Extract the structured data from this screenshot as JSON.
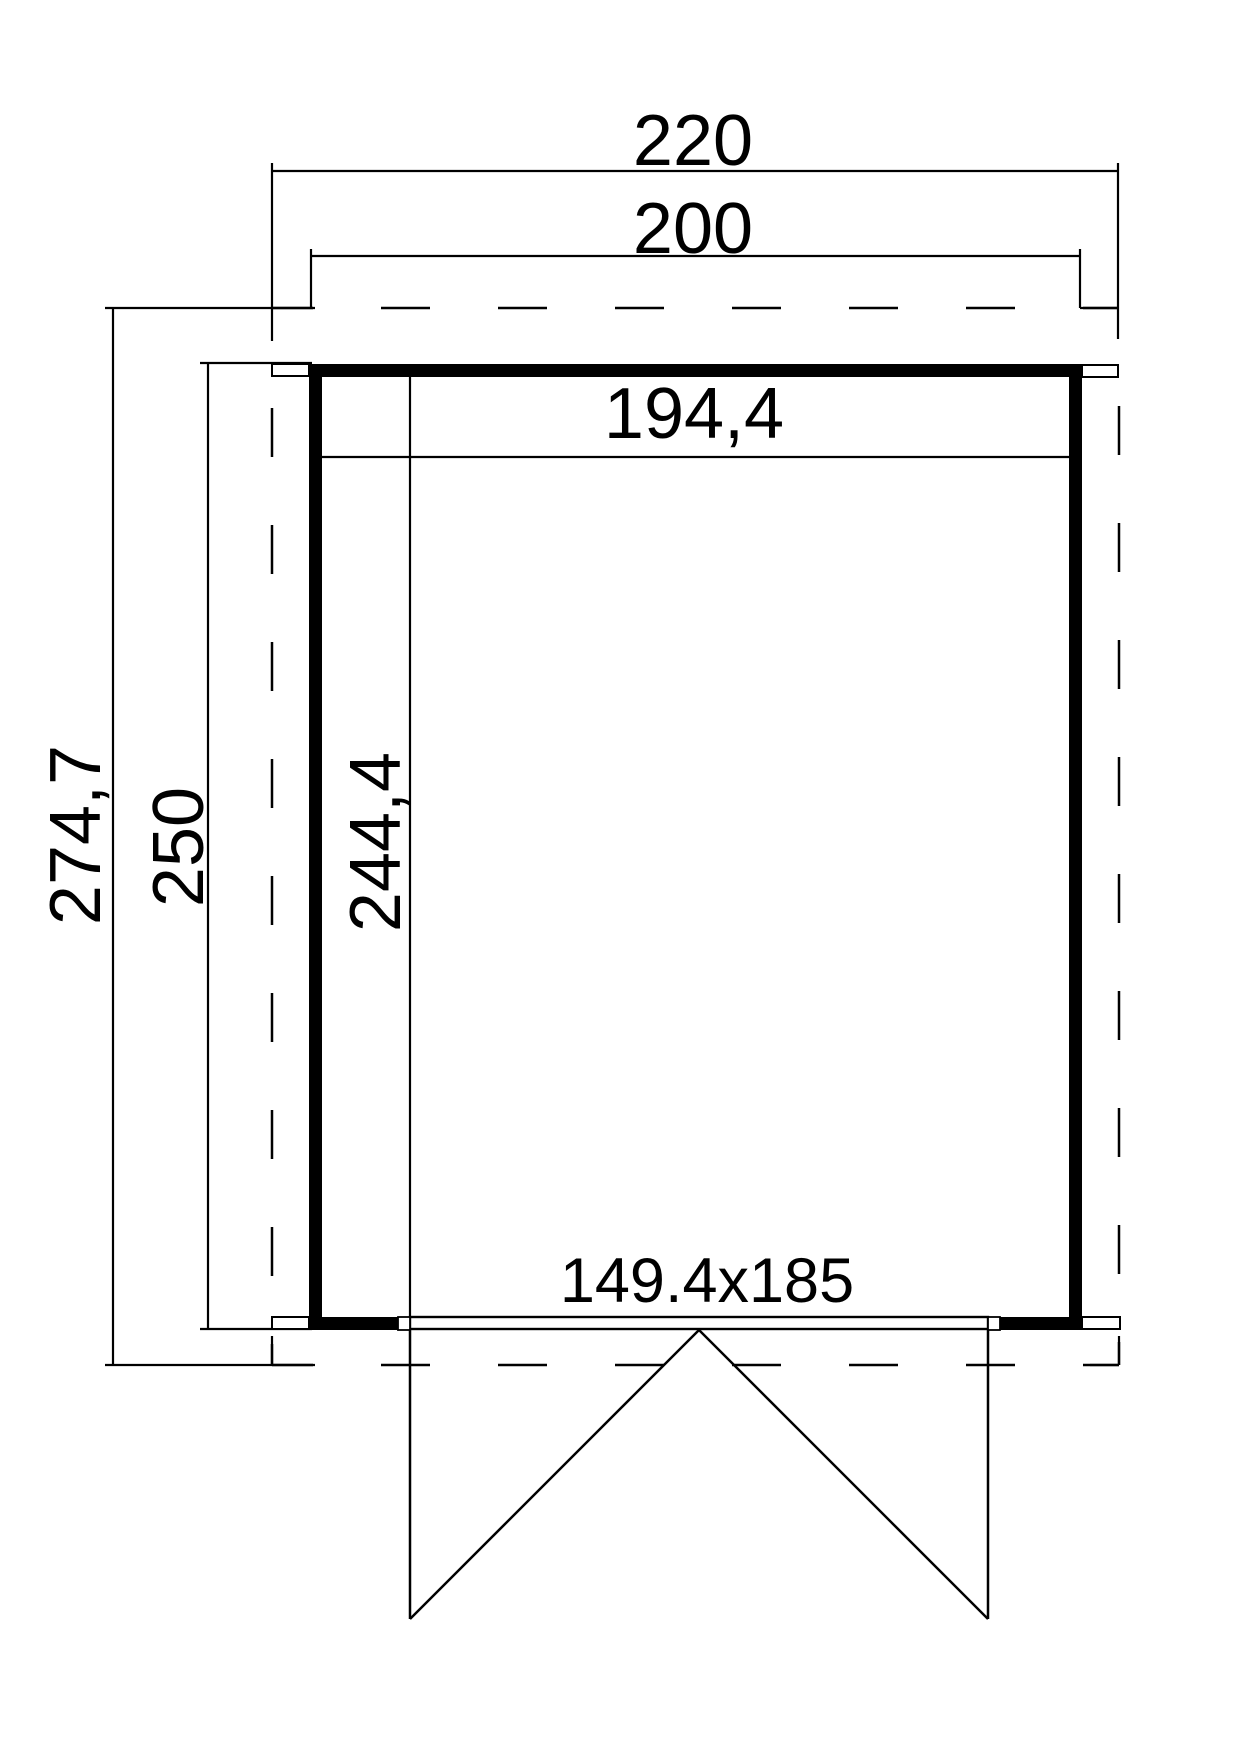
{
  "drawing": {
    "type": "floor-plan",
    "colors": {
      "line": "#000000",
      "background": "#ffffff"
    },
    "dimensions": {
      "roof_width": "220",
      "wall_width": "200",
      "inner_width": "194,4",
      "roof_depth": "274,7",
      "wall_depth": "250",
      "inner_depth": "244,4",
      "door_size": "149.4x185"
    }
  }
}
